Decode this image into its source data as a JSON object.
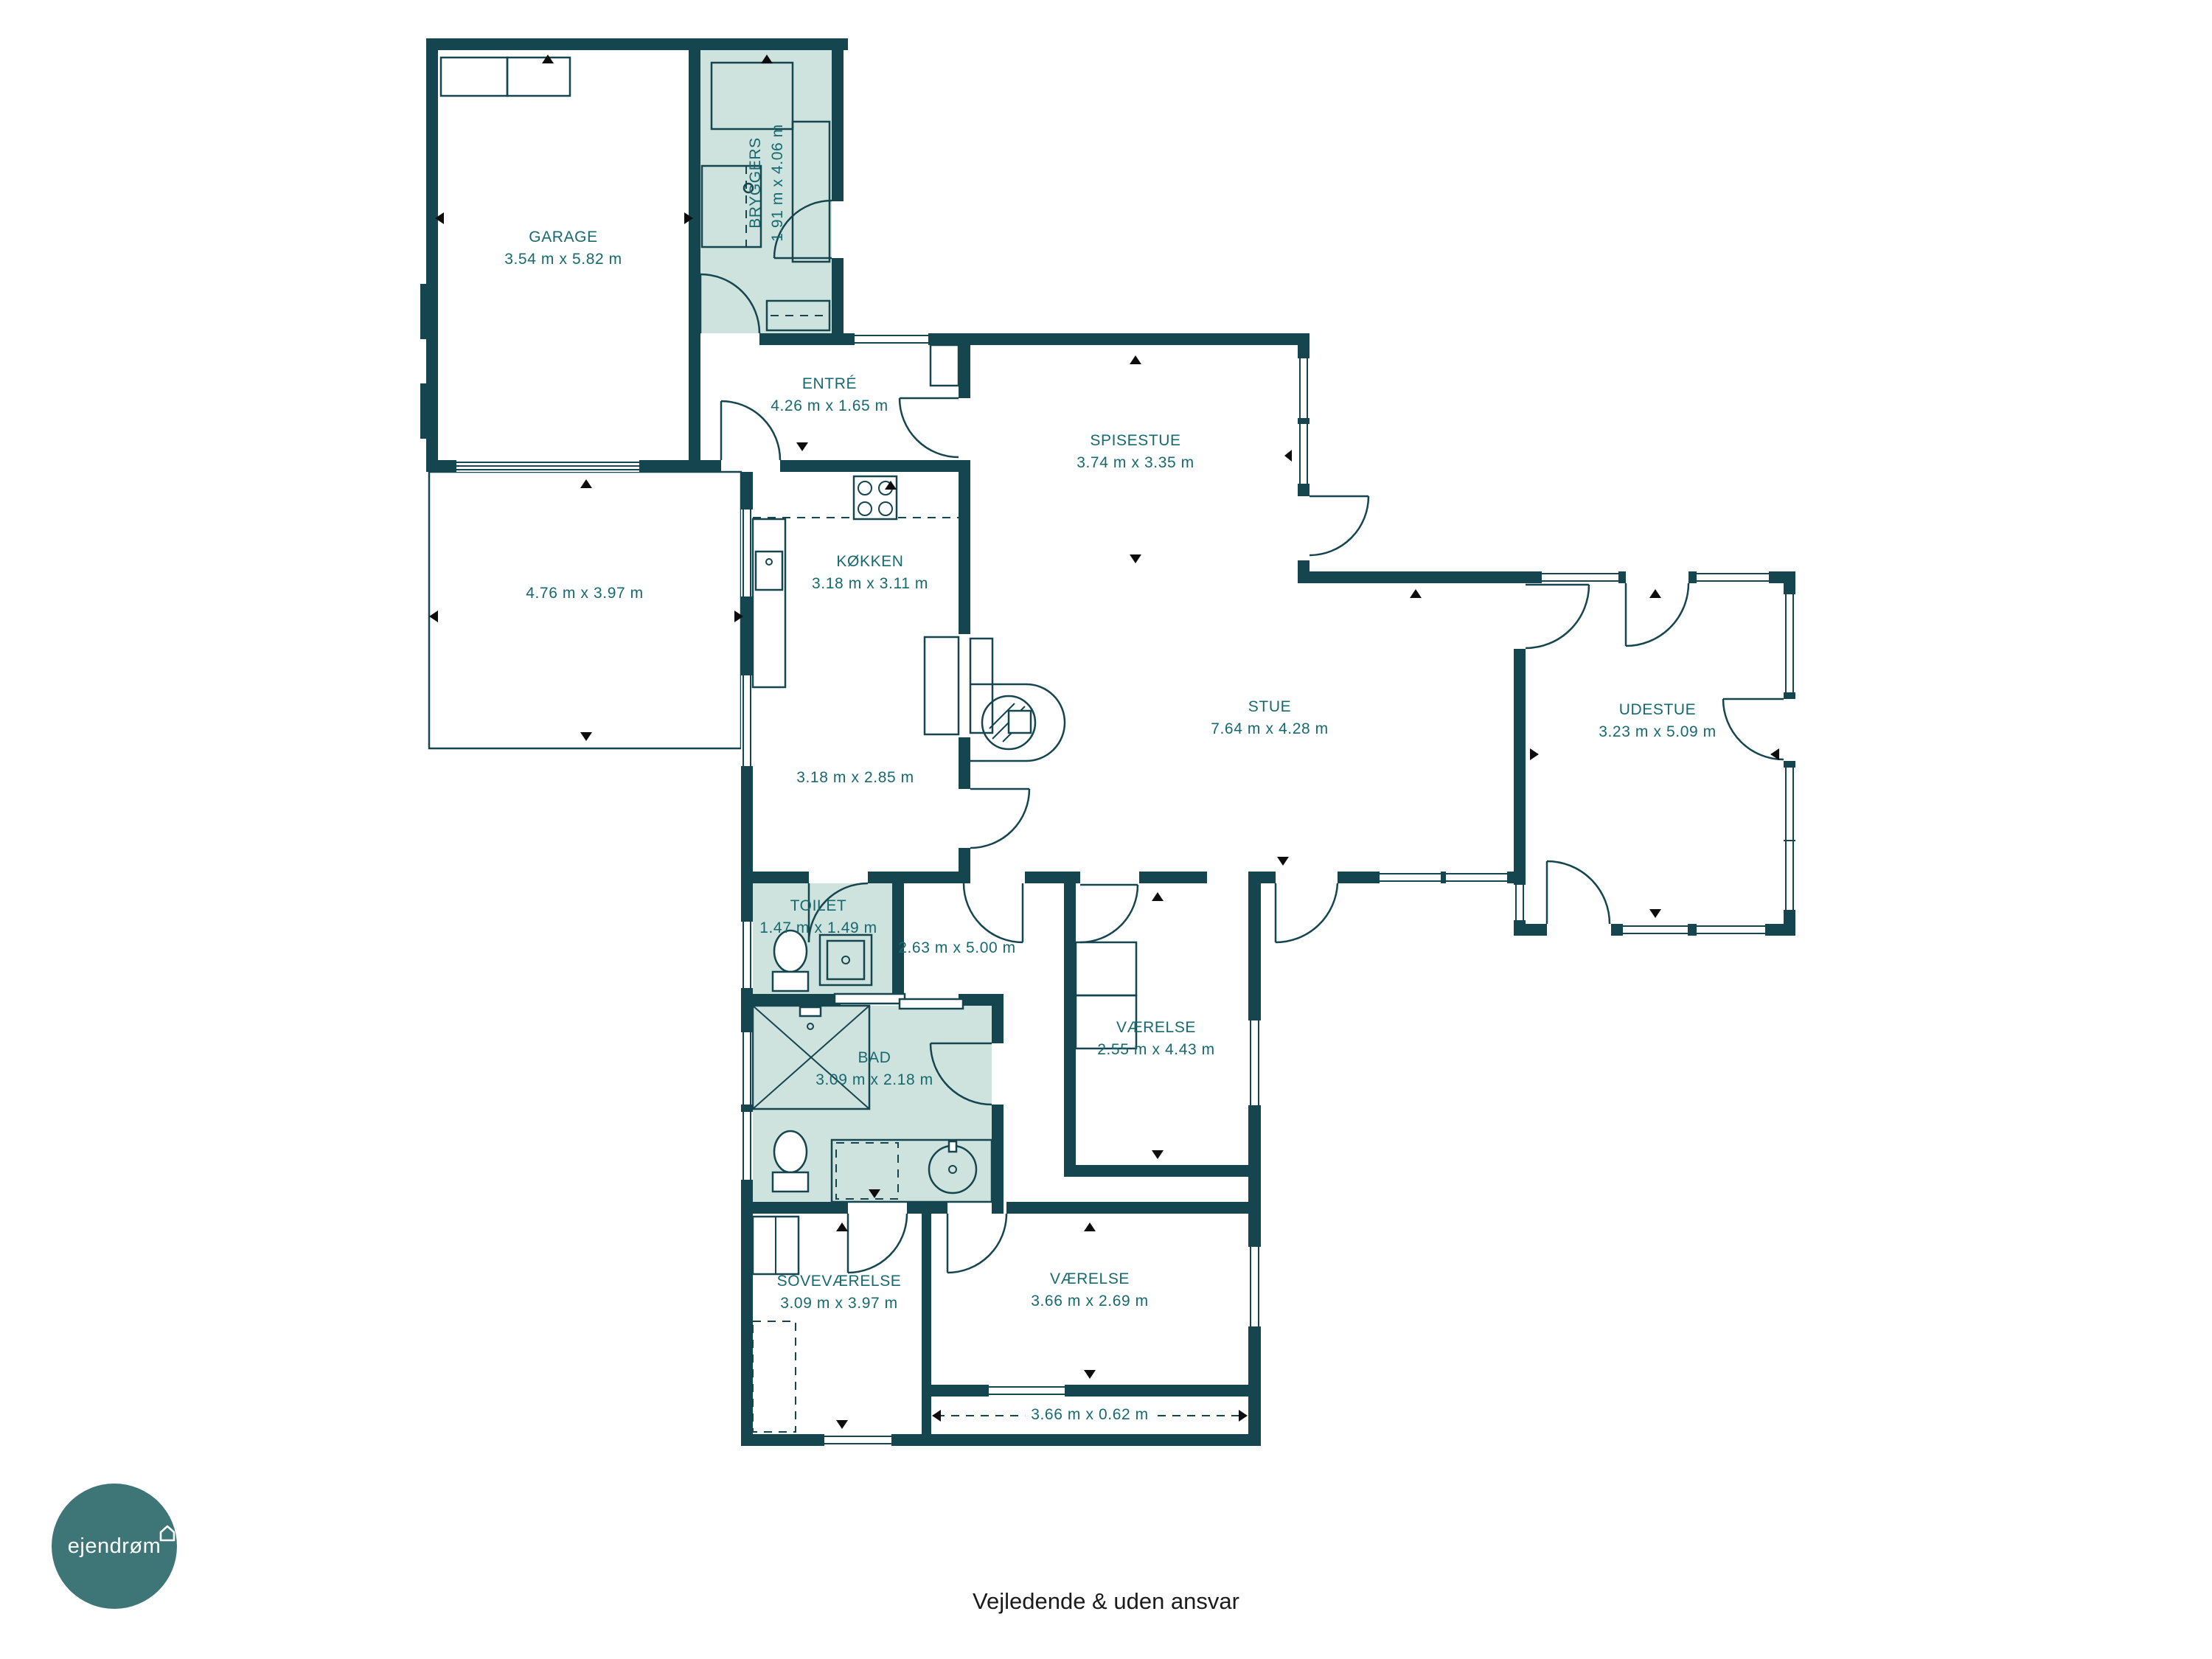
{
  "colors": {
    "wall": "#15454e",
    "highlight": "#cfe3de",
    "label": "#17696f",
    "logo_circle": "#3e7677"
  },
  "logo": {
    "brand": "ejendrøm",
    "icon": "house-icon"
  },
  "footer": {
    "disclaimer": "Vejledende & uden ansvar"
  },
  "rooms": {
    "garage": {
      "name": "GARAGE",
      "dims": "3.54 m x 5.82 m"
    },
    "bryggers": {
      "name": "BRYGGERS",
      "dims": "1.91 m x 4.06 m"
    },
    "entre": {
      "name": "ENTRÉ",
      "dims": "4.26 m x 1.65 m"
    },
    "terrasse": {
      "name": "",
      "dims": "4.76 m x 3.97 m"
    },
    "kokken": {
      "name": "KØKKEN",
      "dims": "3.18 m x 3.11 m"
    },
    "spisestue": {
      "name": "SPISESTUE",
      "dims": "3.74 m x 3.35 m"
    },
    "stue": {
      "name": "STUE",
      "dims": "7.64 m x 4.28 m"
    },
    "udestue": {
      "name": "UDESTUE",
      "dims": "3.23 m x 5.09 m"
    },
    "fordelingsgang": {
      "name": "",
      "dims": "3.18 m x 2.85 m"
    },
    "toilet": {
      "name": "TOILET",
      "dims": "1.47 m x 1.49 m"
    },
    "gang": {
      "name": "",
      "dims": "2.63 m x 5.00 m"
    },
    "vaerelse_ost": {
      "name": "VÆRELSE",
      "dims": "2.55 m x 4.43 m"
    },
    "bad": {
      "name": "BAD",
      "dims": "3.09 m x 2.18 m"
    },
    "sovevaerelse": {
      "name": "SOVEVÆRELSE",
      "dims": "3.09 m x 3.97 m"
    },
    "vaerelse_syd": {
      "name": "VÆRELSE",
      "dims": "3.66 m x 2.69 m"
    },
    "niche": {
      "name": "",
      "dims": "3.66 m x 0.62 m"
    }
  }
}
